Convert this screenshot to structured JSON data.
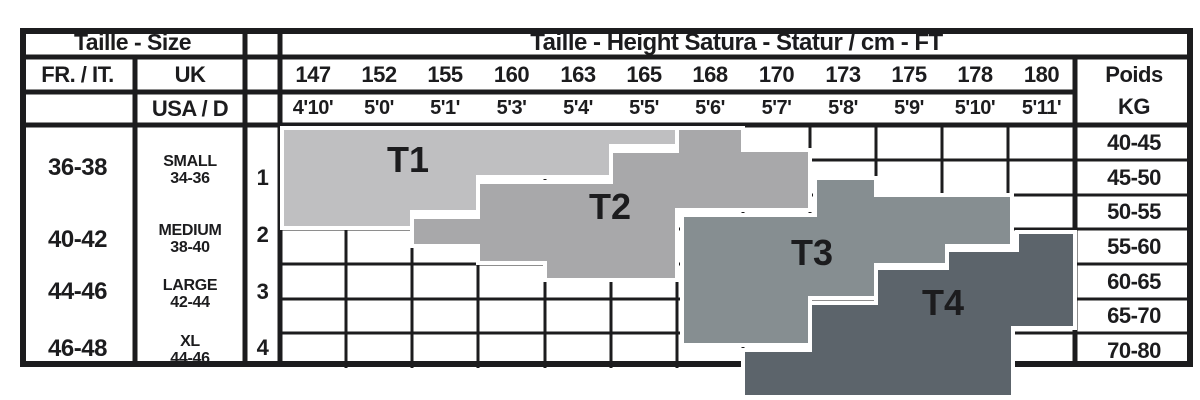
{
  "table": {
    "size_header": "Taille - Size",
    "height_header": "Taille - Height Satura - Statur / cm - FT",
    "col_fr_it": "FR. / IT.",
    "col_uk": "UK",
    "col_usa": "USA / D",
    "heights_cm": [
      "147",
      "152",
      "155",
      "160",
      "163",
      "165",
      "168",
      "170",
      "173",
      "175",
      "178",
      "180"
    ],
    "heights_ft": [
      "4'10'",
      "5'0'",
      "5'1'",
      "5'3'",
      "5'4'",
      "5'5'",
      "5'6'",
      "5'7'",
      "5'8'",
      "5'9'",
      "5'10'",
      "5'11'"
    ],
    "weight_col": {
      "label": "Poids",
      "unit": "KG"
    },
    "weights_kg": [
      "40-45",
      "45-50",
      "50-55",
      "55-60",
      "60-65",
      "65-70",
      "70-80"
    ],
    "sizes": [
      {
        "fr_it": "36-38",
        "uk_label": "SMALL",
        "uk_range": "34-36",
        "usa": "1"
      },
      {
        "fr_it": "40-42",
        "uk_label": "MEDIUM",
        "uk_range": "38-40",
        "usa": "2"
      },
      {
        "fr_it": "44-46",
        "uk_label": "LARGE",
        "uk_range": "42-44",
        "usa": "3"
      },
      {
        "fr_it": "46-48",
        "uk_label": "XL",
        "uk_range": "44-46",
        "usa": "4"
      }
    ]
  },
  "chart_data": {
    "type": "table",
    "title": "Taille - Height Satura - Statur / cm - FT",
    "x_categories_cm": [
      147,
      152,
      155,
      160,
      163,
      165,
      168,
      170,
      173,
      175,
      178,
      180
    ],
    "x_categories_ft": [
      "4'10'",
      "5'0'",
      "5'1'",
      "5'3'",
      "5'4'",
      "5'5'",
      "5'6'",
      "5'7'",
      "5'8'",
      "5'9'",
      "5'10'",
      "5'11'"
    ],
    "y_categories_kg": [
      "40-45",
      "45-50",
      "50-55",
      "55-60",
      "60-65",
      "65-70",
      "70-80"
    ],
    "grid": true,
    "line_color": "#1c1c1e",
    "bands": [
      {
        "label": "T1",
        "color": "#bfbfc1",
        "label_px": [
          408,
          160
        ],
        "approx_kg_by_height_cm": {
          "147": "40-55",
          "152": "40-55",
          "155": "40-52",
          "160": "40-47",
          "163": "40-47",
          "165": "40-42"
        },
        "polygon_px": [
          [
            282,
            128
          ],
          [
            677,
            128
          ],
          [
            677,
            146
          ],
          [
            611,
            146
          ],
          [
            611,
            177
          ],
          [
            478,
            177
          ],
          [
            478,
            212
          ],
          [
            412,
            212
          ],
          [
            412,
            228
          ],
          [
            282,
            228
          ]
        ]
      },
      {
        "label": "T2",
        "color": "#a8a8aa",
        "label_px": [
          610,
          207
        ],
        "approx_kg_by_height_cm": {
          "155": "52-55",
          "160": "47-60",
          "163": "47-65",
          "165": "42-65",
          "168": "40-52",
          "170": "42-52"
        },
        "polygon_px": [
          [
            412,
            217
          ],
          [
            478,
            217
          ],
          [
            478,
            182
          ],
          [
            611,
            182
          ],
          [
            611,
            151
          ],
          [
            677,
            151
          ],
          [
            677,
            128
          ],
          [
            743,
            128
          ],
          [
            743,
            150
          ],
          [
            810,
            150
          ],
          [
            810,
            210
          ],
          [
            677,
            210
          ],
          [
            677,
            280
          ],
          [
            545,
            280
          ],
          [
            545,
            263
          ],
          [
            478,
            263
          ],
          [
            478,
            246
          ],
          [
            412,
            246
          ]
        ]
      },
      {
        "label": "T3",
        "color": "#868e91",
        "label_px": [
          812,
          253
        ],
        "approx_kg_by_height_cm": {
          "168": "52-75",
          "170": "52-75",
          "173": "47-65",
          "175": "50-60",
          "178": "50-57"
        },
        "polygon_px": [
          [
            682,
            215
          ],
          [
            815,
            215
          ],
          [
            815,
            178
          ],
          [
            876,
            178
          ],
          [
            876,
            195
          ],
          [
            1012,
            195
          ],
          [
            1012,
            246
          ],
          [
            947,
            246
          ],
          [
            947,
            265
          ],
          [
            876,
            265
          ],
          [
            876,
            298
          ],
          [
            810,
            298
          ],
          [
            810,
            345
          ],
          [
            682,
            345
          ]
        ]
      },
      {
        "label": "T4",
        "color": "#5c646b",
        "label_px": [
          943,
          303
        ],
        "approx_kg_by_height_cm": {
          "170": "75-80",
          "173": "65-80",
          "175": "60-80",
          "178": "57-80",
          "180": "55-70"
        },
        "polygon_px": [
          [
            743,
            350
          ],
          [
            810,
            350
          ],
          [
            810,
            303
          ],
          [
            876,
            303
          ],
          [
            876,
            268
          ],
          [
            947,
            268
          ],
          [
            947,
            250
          ],
          [
            1017,
            250
          ],
          [
            1017,
            232
          ],
          [
            1075,
            232
          ],
          [
            1075,
            328
          ],
          [
            1013,
            328
          ],
          [
            1013,
            397
          ],
          [
            743,
            397
          ]
        ]
      }
    ],
    "geometry": {
      "outer_border_px": [
        23,
        31,
        1167,
        333
      ],
      "body_grid_x": [
        280,
        346,
        412,
        478,
        545,
        611,
        677,
        743,
        810,
        876,
        942,
        1008,
        1075
      ],
      "body_grid_y": [
        125,
        160,
        195,
        229,
        264,
        299,
        333,
        368
      ],
      "right_edge_x": 1193,
      "left_edge_x": 20,
      "structural_h": [
        [
          57,
          20,
          1193
        ],
        [
          92,
          20,
          1075
        ],
        [
          125,
          20,
          1193
        ]
      ],
      "structural_v": [
        [
          135,
          57,
          367
        ],
        [
          245,
          28,
          367
        ],
        [
          280,
          28,
          367
        ],
        [
          1075,
          57,
          367
        ]
      ]
    }
  }
}
